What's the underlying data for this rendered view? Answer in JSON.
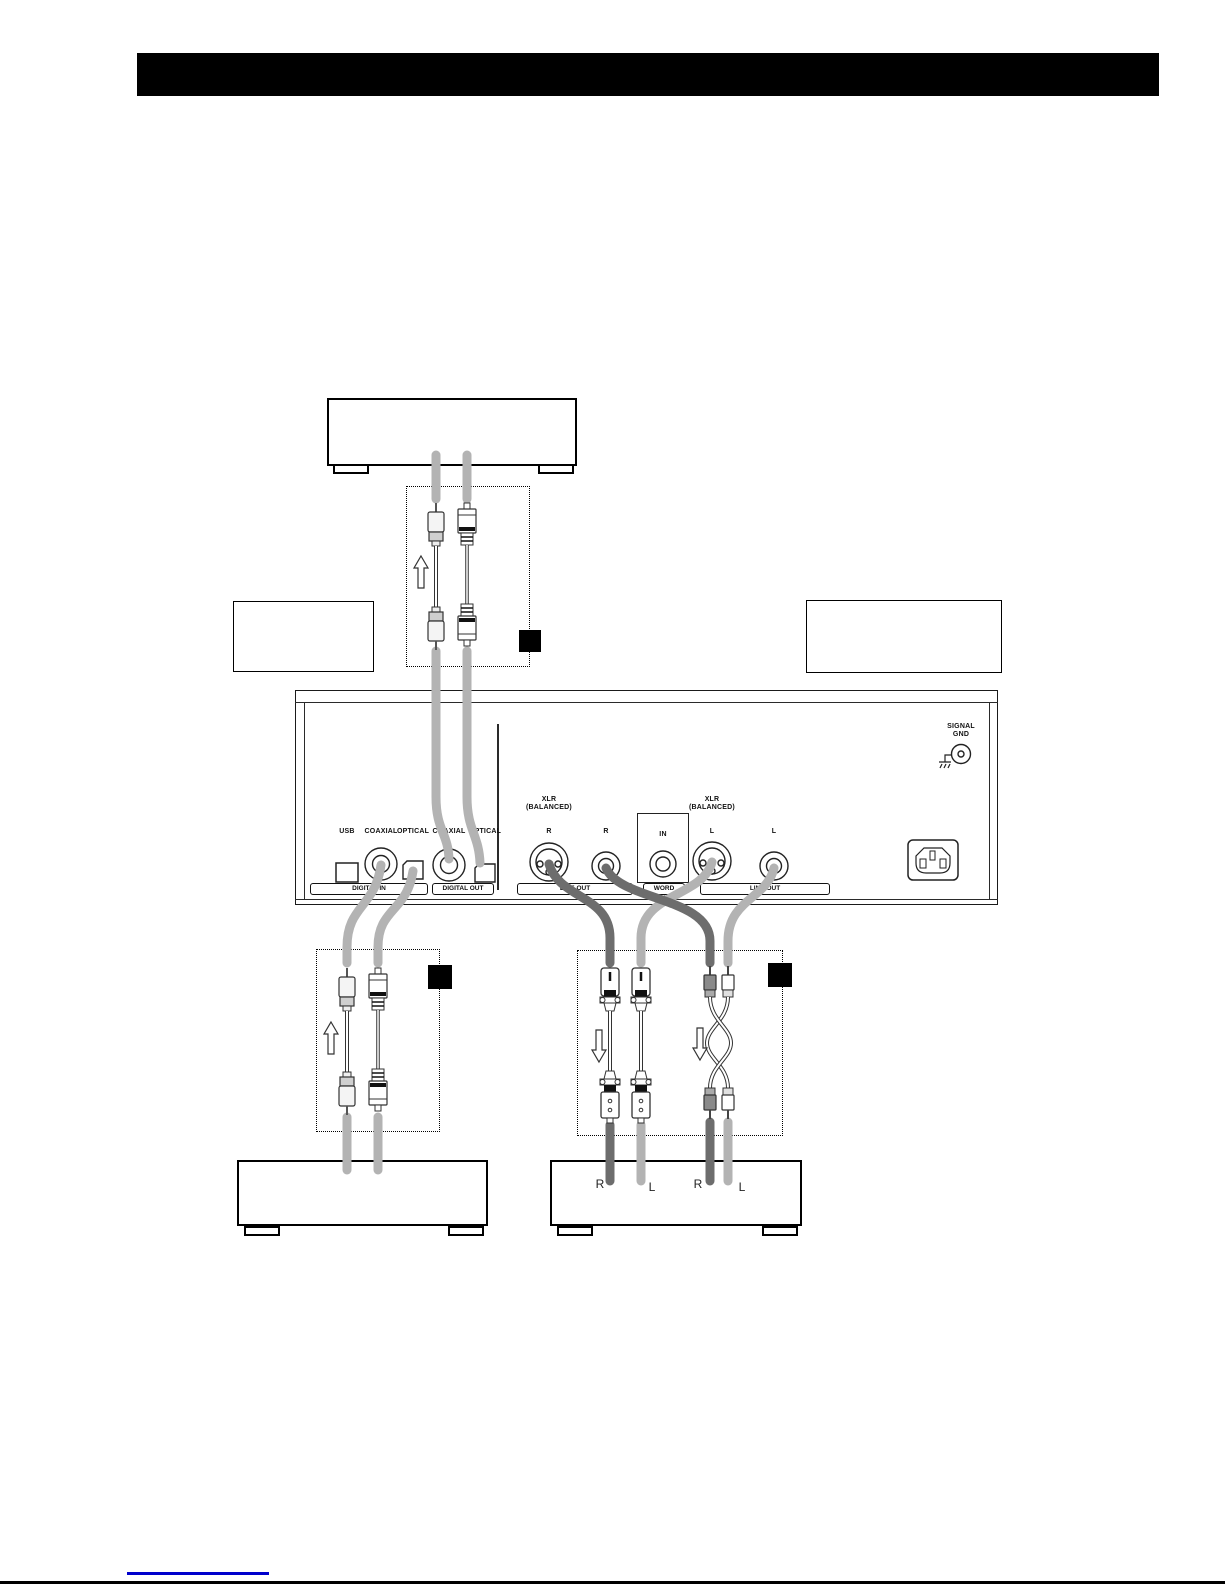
{
  "colors": {
    "cable_light": "#b3b3b3",
    "cable_dark": "#6d6d6d",
    "link_underline": "#0000cc"
  },
  "rear_panel": {
    "digital_in": {
      "bar_label": "DIGITAL IN",
      "usb_label": "USB",
      "coaxial_label": "COAXIAL",
      "optical_label": "OPTICAL"
    },
    "digital_out": {
      "bar_label": "DIGITAL OUT",
      "coaxial_label": "COAXIAL",
      "optical_label": "OPTICAL"
    },
    "line_out_r": {
      "bar_label": "LINE OUT",
      "xlr_label_line1": "XLR",
      "xlr_label_line2": "(BALANCED)",
      "xlr_channel": "R",
      "rca_channel": "R"
    },
    "word_sync": {
      "bar_label": "WORD SYNC",
      "in_label": "IN"
    },
    "line_out_l": {
      "bar_label": "LINE OUT",
      "xlr_label_line1": "XLR",
      "xlr_label_line2": "(BALANCED)",
      "xlr_channel": "L",
      "rca_channel": "L"
    },
    "signal_gnd": {
      "label_line1": "SIGNAL",
      "label_line2": "GND"
    }
  },
  "cables": {
    "channel_labels": {
      "xlr_r": "R",
      "xlr_l": "L",
      "rca_r": "R",
      "rca_l": "L"
    }
  }
}
